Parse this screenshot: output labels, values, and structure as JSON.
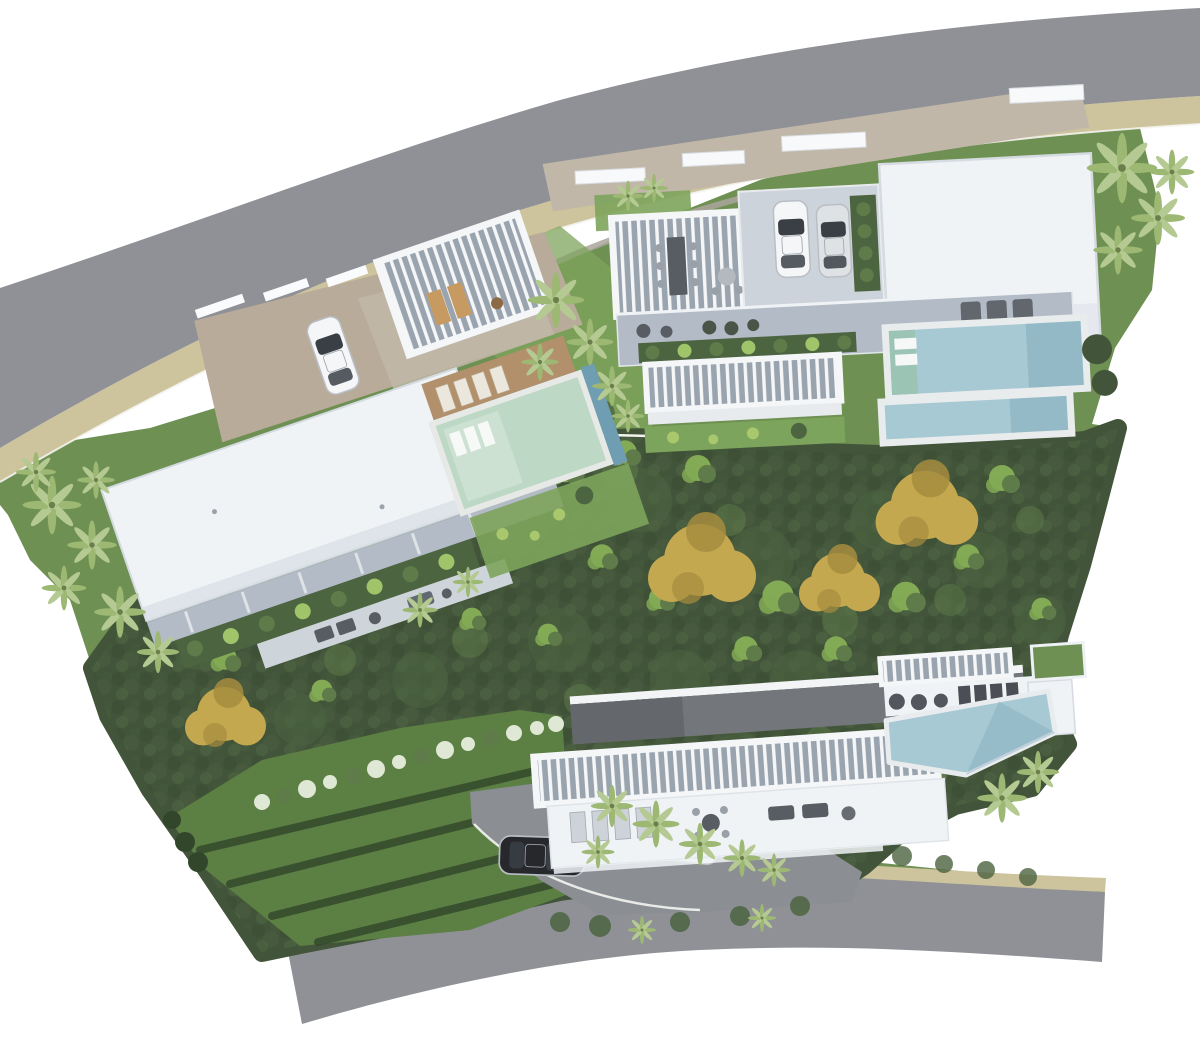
{
  "canvas": {
    "width": 1200,
    "height": 1038,
    "background": "white"
  },
  "scene": {
    "title": "Aerial site plan render",
    "description": "Top-down 3D architectural rendering of a hillside residential plot with three modern flat-roof villas, private pools, parked cars, dense tree canopy, terraced lawns and two curving asphalt roads with sand-colored shoulders."
  },
  "roads": {
    "top": {
      "surface": "asphalt",
      "shoulder": "sand strip on inner edge",
      "route": "curves from the west edge up to the north-east corner"
    },
    "bottom": {
      "surface": "asphalt",
      "shoulder": "sand strip on inner edge",
      "route": "short segment along the south edge, ends mid-image on both sides"
    }
  },
  "villas": [
    {
      "id": "villa-1",
      "position": "west",
      "rotation_deg": -19,
      "features": [
        "gravel entry court",
        "white entry walls",
        "large flat white roof",
        "slatted pergola with wood loungers",
        "mint-green pool with tanning shelf",
        "timber sun deck",
        "planted terrace with bushes",
        "lower terrace with seating"
      ],
      "cars": [
        {
          "color": "white",
          "location": "gravel driveway"
        }
      ],
      "pools": [
        {
          "water": "mint green",
          "loungers_on_shelf": 3
        }
      ]
    },
    {
      "id": "villa-2",
      "position": "north-east",
      "rotation_deg": -3,
      "features": [
        "stone entry court with white canopies",
        "slatted dining pergola with long table",
        "parking deck for two cars",
        "green planting divider",
        "large white main roof",
        "roof terrace with 3 loungers",
        "planted strip",
        "second slatted pergola",
        "two stacked lap pools"
      ],
      "cars": [
        {
          "color": "white",
          "location": "parking deck"
        },
        {
          "color": "silver",
          "location": "parking deck"
        }
      ],
      "pools": [
        {
          "water": "light blue",
          "steps": "green tanning shelf with 2 white loungers"
        },
        {
          "water": "light blue",
          "note": "lower offset lap pool"
        }
      ]
    },
    {
      "id": "villa-3",
      "position": "south",
      "rotation_deg": -4,
      "features": [
        "dark roof deck band",
        "long slatted pergola",
        "white terrace with loungers, round table and sofas",
        "roof patch of lawn",
        "barbecue circles and 4 dark loungers",
        "angled infinity pool",
        "palm courtyard",
        "gray driveway to south road"
      ],
      "cars": [
        {
          "color": "black",
          "location": "driveway"
        },
        {
          "color": "white",
          "location": "driveway"
        }
      ],
      "pools": [
        {
          "water": "light blue",
          "shape": "angled pentagon"
        }
      ]
    }
  ],
  "vehicles_total": 5,
  "vegetation": {
    "canopy": "dense dark-green mixed tree canopy filling the center of the plot",
    "light_green_tree_clumps": 18,
    "yellow_flowering_tree_clusters": 4,
    "palm_groups": [
      "west boundary",
      "central garden between villas",
      "north-east corner",
      "villa-3 courtyard",
      "south hedge"
    ],
    "terraced_lawn": {
      "location": "south-west",
      "hedge_rows": 4
    },
    "white_flower_hedge_row": true
  },
  "colors": {
    "road": "#8f9196",
    "shoulder": "#cdc39c",
    "curb": "#f4f4ef",
    "wall": "#aaa69c",
    "lawn": "#6e9052",
    "lawn_light": "#7da45c",
    "terrace_lawn": "#5c7f43",
    "hedge": "#31462b",
    "forest": "#42553a",
    "forest_mid": "#4d6441",
    "forest_light": "#5f7b4a",
    "tree_light": "#83aa55",
    "tree_yellow": "#c3a84f",
    "tree_yellow_deep": "#a68c3e",
    "palm_frond": "#9cb873",
    "palm_frond_light": "#b5ca92",
    "roof_white": "#f0f3f6",
    "roof_shade": "#d9e0e7",
    "building": "#b3bbc6",
    "deck": "#ccd3da",
    "pergola": "#9aa4af",
    "slat": "#f4f6f8",
    "gravel": "#b9ab99",
    "paver": "#c1b7a8",
    "roof_dark": "#73767b",
    "drive": "#8b8e93",
    "pool": "#a7c9d3",
    "pool_deep": "#7fa9bb",
    "pool_mint": "#bdd8c5",
    "pool_step": "#9cc4b4",
    "wood": "#b2906b",
    "furniture": "#585d64",
    "flower": "#dfe8d4",
    "car_white": "#f4f6f8",
    "car_silver": "#dfe2e5",
    "car_black": "#26282c",
    "glass": "#3a3f46"
  }
}
